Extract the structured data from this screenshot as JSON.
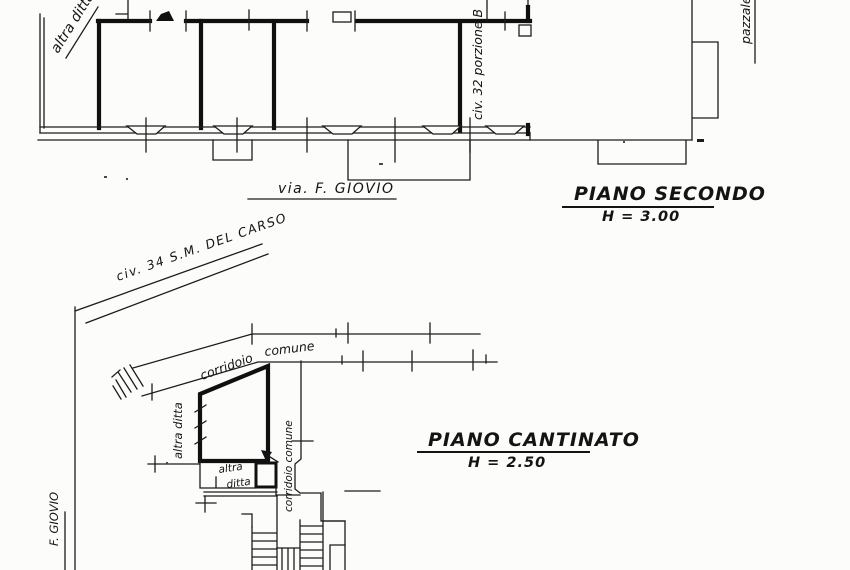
{
  "scan": {
    "upper_plan": {
      "title": "PIANO SECONDO",
      "height": "H = 3.00",
      "street": "via.  F. GIOVIO",
      "neighbor_diagonal": "altra ditta",
      "unit": "civ. 32 porzione B",
      "side_area": "pazzale"
    },
    "lower_plan": {
      "title": "PIANO CANTINATO",
      "height": "H = 2.50",
      "street_diagonal": "civ. 34  S.M. DEL CARSO",
      "street_vertical": "F. GIOVIO",
      "corridor_word1": "corridoio",
      "corridor_word2": "comune",
      "neighbor_vertical": "altra ditta",
      "neighbor_small_line1": "altra",
      "neighbor_small_line2": "ditta",
      "corridor_vertical": "corridoio comune"
    },
    "ink_color": "#141414"
  }
}
